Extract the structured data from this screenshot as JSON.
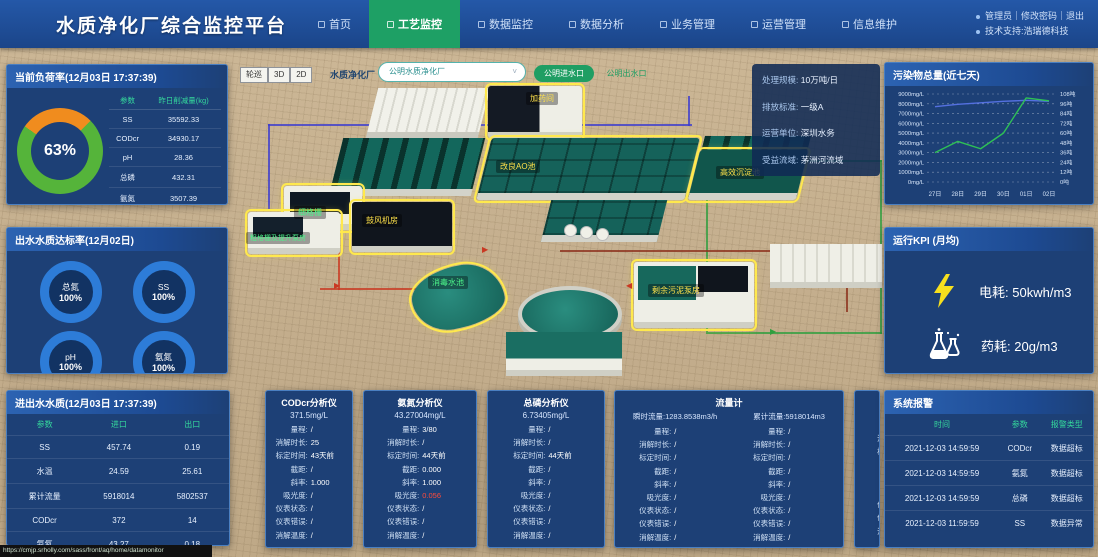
{
  "header": {
    "title": "水质净化厂综合监控平台",
    "nav": [
      {
        "label": "首页",
        "active": false
      },
      {
        "label": "工艺监控",
        "active": true
      },
      {
        "label": "数据监控",
        "active": false
      },
      {
        "label": "数据分析",
        "active": false
      },
      {
        "label": "业务管理",
        "active": false
      },
      {
        "label": "运营管理",
        "active": false
      },
      {
        "label": "信息维护",
        "active": false
      }
    ],
    "user_links": "管理员｜修改密码｜退出",
    "support": "技术支持:浩瑞德科技"
  },
  "toolbar": {
    "patrol": "轮巡",
    "btn_3d": "3D",
    "btn_2d": "2D",
    "plant_label": "水质净化厂",
    "plant_select": "公明水质净化厂",
    "inlet_btn": "公明进水口",
    "outlet_btn": "公明出水口"
  },
  "load_panel": {
    "title": "当前负荷率(12月03日 17:37:39)",
    "percent": "63%",
    "donut": {
      "green": "#55b43a",
      "orange": "#f08c1e"
    },
    "col_param": "参数",
    "col_value": "昨日削减量(kg)",
    "rows": [
      [
        "SS",
        "35592.33"
      ],
      [
        "CODcr",
        "34930.17"
      ],
      [
        "pH",
        "28.36"
      ],
      [
        "总磷",
        "432.31"
      ],
      [
        "氨氮",
        "3507.39"
      ]
    ]
  },
  "compliance_panel": {
    "title": "出水水质达标率(12月02日)",
    "gauges": [
      {
        "label": "总氮",
        "value": "100%"
      },
      {
        "label": "SS",
        "value": "100%"
      },
      {
        "label": "pH",
        "value": "100%"
      },
      {
        "label": "氨氮",
        "value": "100%"
      }
    ]
  },
  "inout_panel": {
    "title": "进出水水质(12月03日 17:37:39)",
    "headers": [
      "参数",
      "进口",
      "出口"
    ],
    "rows": [
      [
        "SS",
        "457.74",
        "0.19"
      ],
      [
        "水温",
        "24.59",
        "25.61"
      ],
      [
        "累计流量",
        "5918014",
        "5802537"
      ],
      [
        "CODcr",
        "372",
        "14"
      ],
      [
        "氨氮",
        "43.27",
        "0.18"
      ],
      [
        "总磷",
        "4.43",
        "0.31"
      ]
    ]
  },
  "plant_info": {
    "rows": [
      [
        "处理规模:",
        "10万吨/日"
      ],
      [
        "排放标准:",
        "一级A"
      ],
      [
        "运营单位:",
        "深圳水务"
      ],
      [
        "受益流域:",
        "茅洲河流域"
      ]
    ]
  },
  "scene": {
    "labels": {
      "dosing": "加药间",
      "ao": "改良AO池",
      "sedimentation": "高效沉淀池",
      "fine_screen": "细格栅",
      "coarse_screen": "粗格栅及提升泵房",
      "blower": "鼓风机房",
      "disinfect": "消毒水池",
      "sludge": "剩余污泥泵房"
    }
  },
  "chart_data": {
    "type": "line",
    "title": "污染物总量(近七天)",
    "x": [
      "27日",
      "28日",
      "29日",
      "30日",
      "01日",
      "02日"
    ],
    "series": [
      {
        "name": "浓度(mg/L)",
        "color": "#5470e0",
        "values": [
          7700,
          7950,
          8100,
          8250,
          8350,
          8250
        ]
      },
      {
        "name": "总量(吨)",
        "color": "#2ec155",
        "values": [
          3000,
          4150,
          3400,
          5000,
          8600,
          8300
        ]
      }
    ],
    "ylim_left": [
      0,
      9000
    ],
    "yticks_left": [
      "9000mg/L",
      "8000mg/L",
      "7000mg/L",
      "6000mg/L",
      "5000mg/L",
      "4000mg/L",
      "3000mg/L",
      "2000mg/L",
      "1000mg/L",
      "0mg/L"
    ],
    "ylim_right": [
      0,
      108
    ],
    "yticks_right": [
      "108吨",
      "96吨",
      "84吨",
      "72吨",
      "60吨",
      "48吨",
      "36吨",
      "24吨",
      "12吨",
      "0吨"
    ],
    "grid": true,
    "legend": "none"
  },
  "kpi_panel": {
    "title": "运行KPI (月均)",
    "items": [
      {
        "icon": "lightning-icon",
        "label": "电耗:",
        "value": "50kwh/m3"
      },
      {
        "icon": "flask-icon",
        "label": "药耗:",
        "value": "20g/m3"
      }
    ]
  },
  "alarm_panel": {
    "title": "系统报警",
    "headers": [
      "时间",
      "参数",
      "报警类型"
    ],
    "rows": [
      [
        "2021-12-03 14:59:59",
        "CODcr",
        "数据超标"
      ],
      [
        "2021-12-03 14:59:59",
        "氨氮",
        "数据超标"
      ],
      [
        "2021-12-03 14:59:59",
        "总磷",
        "数据超标"
      ],
      [
        "2021-12-03 11:59:59",
        "SS",
        "数据异常"
      ]
    ]
  },
  "analyzers": [
    {
      "title": "CODcr分析仪",
      "value": "371.5mg/L",
      "fields": [
        [
          "量程:",
          "/"
        ],
        [
          "消解时长:",
          "25"
        ],
        [
          "标定时间:",
          "43天前"
        ],
        [
          "截距:",
          "/"
        ],
        [
          "斜率:",
          "1.000"
        ],
        [
          "吸光度:",
          "/"
        ],
        [
          "仪表状态:",
          "/"
        ],
        [
          "仪表错误:",
          "/"
        ],
        [
          "消解温度:",
          "/"
        ]
      ]
    },
    {
      "title": "氨氮分析仪",
      "value": "43.27004mg/L",
      "fields": [
        [
          "量程:",
          "3/80"
        ],
        [
          "消解时长:",
          "/"
        ],
        [
          "标定时间:",
          "44天前"
        ],
        [
          "截距:",
          "0.000"
        ],
        [
          "斜率:",
          "1.000"
        ],
        [
          "吸光度:",
          "0.056",
          "red"
        ],
        [
          "仪表状态:",
          "/"
        ],
        [
          "仪表错误:",
          "/"
        ],
        [
          "消解温度:",
          "/"
        ]
      ]
    },
    {
      "title": "总磷分析仪",
      "value": "6.73405mg/L",
      "fields": [
        [
          "量程:",
          "/"
        ],
        [
          "消解时长:",
          "/"
        ],
        [
          "标定时间:",
          "44天前"
        ],
        [
          "截距:",
          "/"
        ],
        [
          "斜率:",
          "/"
        ],
        [
          "吸光度:",
          "/"
        ],
        [
          "仪表状态:",
          "/"
        ],
        [
          "仪表错误:",
          "/"
        ],
        [
          "消解温度:",
          "/"
        ]
      ]
    }
  ],
  "flowmeter": {
    "title": "流量计",
    "instant_label": "瞬时流量:",
    "instant_value": "1283.8538m3/h",
    "total_label": "累计流量:",
    "total_value": "5918014m3",
    "fields": [
      [
        "量程:",
        "/"
      ],
      [
        "消解时长:",
        "/"
      ],
      [
        "标定时间:",
        "/"
      ],
      [
        "截距:",
        "/"
      ],
      [
        "斜率:",
        "/"
      ],
      [
        "吸光度:",
        "/"
      ],
      [
        "仪表状态:",
        "/"
      ],
      [
        "仪表错误:",
        "/"
      ],
      [
        "消解温度:",
        "/"
      ]
    ]
  },
  "statusbar": {
    "url": "https://cmjp.srholly.com/sass/front/aq/home/datamonitor"
  }
}
